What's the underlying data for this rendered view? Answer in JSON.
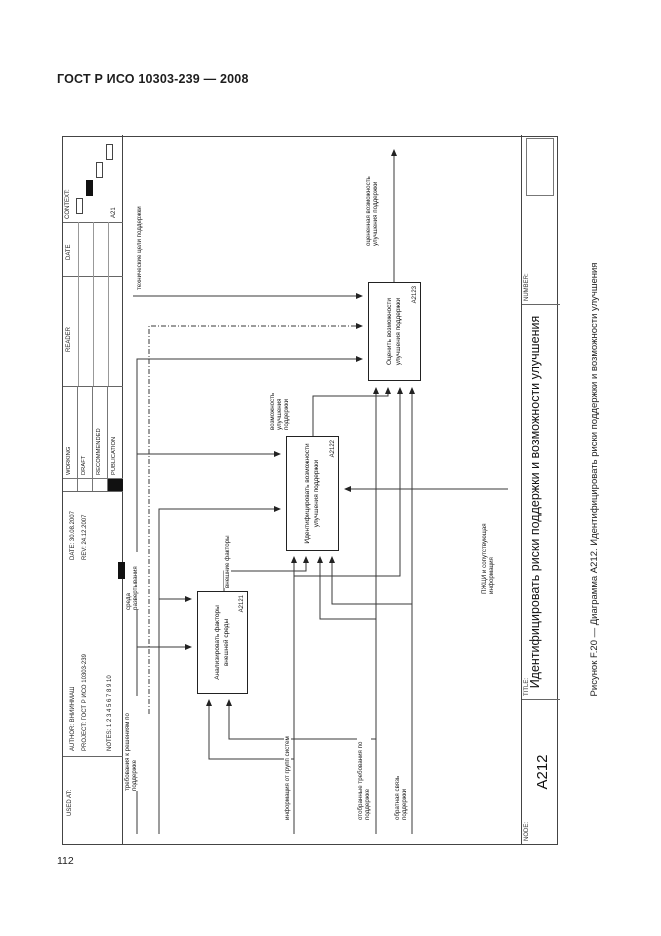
{
  "page": {
    "header": "ГОСТ Р ИСО 10303-239 — 2008",
    "page_number": "112",
    "caption": "Рисунок F.20 — Диаграмма А212. Идентифицировать риски поддержки и возможности улучшения"
  },
  "title_block": {
    "used_at": "USED AT:",
    "author_label": "AUTHOR:",
    "author_value": "ВНИИНМАШ",
    "project_label": "PROJECT:",
    "project_value": "ГОСТ Р ИСО 10303-239",
    "notes_label": "NOTES:",
    "notes_value": "1 2 3 4 5 6 7 8 9 10",
    "date_label": "DATE:",
    "date_value": "30.08.2007",
    "rev_label": "REV:",
    "rev_value": "24.12.2007",
    "status": [
      "WORKING",
      "DRAFT",
      "RECOMMENDED",
      "PUBLICATION"
    ],
    "reader_label": "READER",
    "reader_date_label": "DATE",
    "context_label": "CONTEXT:",
    "context_node": "A21"
  },
  "node_bar": {
    "node_label": "NODE:",
    "node_value": "А212",
    "title_label": "TITLE:",
    "title_value": "Идентифицировать риски поддержки и возможности улучшения",
    "number_label": "NUMBER:"
  },
  "diagram": {
    "boxes": [
      {
        "id": "A2121",
        "text": "Анализировать факторы внешней среды"
      },
      {
        "id": "A2122",
        "text": "Идентифицировать возможности улучшения поддержки"
      },
      {
        "id": "A2123",
        "text": "Оценить возможности улучшения поддержки"
      }
    ],
    "arrow_labels": [
      {
        "text": "требования к решениям по поддержке"
      },
      {
        "text": "среда развертывания"
      },
      {
        "text": "технические цели поддержки"
      },
      {
        "text": "внешние факторы"
      },
      {
        "text": "возможность улучшения поддержки"
      },
      {
        "text": "оцененная возможность улучшения поддержки"
      },
      {
        "text": "информация от групп систем"
      },
      {
        "text": "отобранные требования по поддержке"
      },
      {
        "text": "обратная связь поддержки"
      },
      {
        "text": "ПЖЦИ и сопутствующая информация"
      }
    ]
  },
  "colors": {
    "ink": "#1d1d1d",
    "line": "#3a3a3a"
  }
}
